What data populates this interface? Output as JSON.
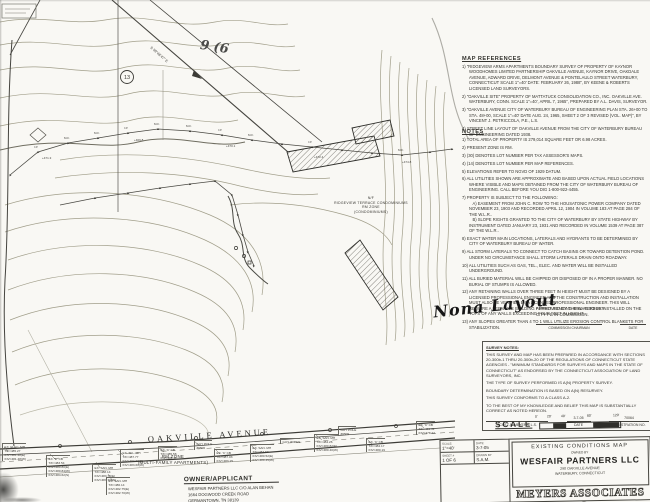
{
  "colors": {
    "paper": "#f9f8f4",
    "ink": "#2e2d29",
    "pencil": "#4a4a48",
    "contour": "#93907f"
  },
  "map": {
    "street": "OAKVILLE AVENUE",
    "bearing": "S 59°48'47\" E",
    "circled_lot": "13",
    "pencil_note": "9 (6",
    "zone_mf": [
      "RM ZONE",
      "(MULTI-FAMILY APARTMENTS)"
    ],
    "zone_condo": [
      "N/F",
      "RIDGEVIEW TERRACE CONDOMINIUMS",
      "RM ZONE",
      "(CONDOMINIUMS)"
    ],
    "pins": [
      "I.P.",
      "M.F.",
      "M.F.",
      "I.P.",
      "M.F.",
      "M.F.",
      "I.P.",
      "M.F.",
      "I.P.",
      "M.F."
    ],
    "elevs": [
      "+471.3",
      "+469.8",
      "+470.1",
      "+472.4",
      "+474.8"
    ],
    "callouts": [
      {
        "lines": [
          "EX. ELEC. MH",
          "T/F=485.27",
          "INV=481.48(E)",
          "INV=481.48(W)"
        ]
      },
      {
        "lines": [
          "EX. 'C' CB",
          "T/F=483.54",
          "INV=480.80(E)",
          "INV=480.84(W)",
          "INV=484.62(S)"
        ]
      },
      {
        "lines": [
          "EX. SAN. MH",
          "T/F=488.14",
          "INV=483.75(E)",
          "INV=483.70(W)"
        ]
      },
      {
        "lines": [
          "EX. TEL. MH",
          "T/F=487.77",
          "INV=483.60(E)",
          "INV=483.60(W)"
        ]
      },
      {
        "lines": [
          "EX. 'C' CB",
          "T/F=485.58",
          "INV=481.11"
        ]
      },
      {
        "lines": [
          "GUY POLE",
          "#6506"
        ]
      },
      {
        "lines": [
          "EX. 'C' CB",
          "T/F=487.03",
          "INV=483.15"
        ]
      },
      {
        "lines": [
          "EX. SAN. MH",
          "T/F=483.62",
          "INV=480.52(E)",
          "INV=480.45(W)"
        ]
      },
      {
        "lines": [
          "GUY WIRES"
        ]
      },
      {
        "lines": [
          "EX. SAN. MH",
          "T/F=484.26",
          "INV=480.82(E)",
          "INV=480.40(W)"
        ]
      },
      {
        "lines": [
          "GUY POLE",
          "#6509"
        ]
      },
      {
        "lines": [
          "EX. 'C' CB",
          "T/F=484.17",
          "INV=480.19"
        ]
      },
      {
        "lines": [
          "EX. 'C' CB",
          "T/F=481.41",
          "INV=478.22"
        ]
      },
      {
        "lines": [
          "EX. SAN. MH",
          "T/F=486.14",
          "INV=482.75(E)",
          "INV=482.70(W)"
        ]
      }
    ]
  },
  "owner_block": {
    "title": "OWNER/APPLICANT",
    "lines": [
      "WESFAIR PARTNERS LLC C/O ALAN BEHAN",
      "1664 DOGWOOD CREEK ROAD",
      "GERMANTOWN, TN 38139",
      "PH. (203) 755-3352"
    ]
  },
  "map_references": {
    "title": "MAP REFERENCES",
    "items": [
      "1) \"RIDGEVIEW ARMS APARTMENTS BOUNDARY SURVEY OF PROPERTY OF KAYNOR WOODHOMES LIMITED PARTNERSHIP OAKVILLE AVENUE, KAYNOR DRIVE, OAKDALE AVENUE, ADWARD DRIVE, DELMONT AVENUE & PONTELAULO STREET WATERBURY, CONNECTICUT SCALE 1\"=40' DATE: FEBRUARY 26, 1988\", BY KEENE & ROBERTS LICENSED LAND SURVEYORS.",
      "2) \"OAKVILLE SITE\" PROPERTY OF MATTATUCK CONSOLIDATION CO., INC. OAKVILLE AVE. WATERBURY, CONN. SCALE 1\"=40', APRIL 7, 1965\", PREPARED BY A.L. DAVIS, SURVEYOR.",
      "3) \"OAKVILLE AVENUE CITY OF WATERBURY BUREAU OF ENGINEERING PLAN STA. 26+00 TO STA. 48+00, SCALE 1\"=40' DATE AUG. 24, 1965, SHEET 2 OF 3 REVISED (VOL. MAP)\", BY VINCENT J. PETRICCOLA, P.E., L.S.",
      "4) STREET LINE LAYOUT OF OAKVILLE AVENUE FROM THE CITY OF WATERBURY BUREAU OF ENGINEERING DATED 1938."
    ]
  },
  "notes": {
    "title": "NOTES",
    "items": [
      "1) TOTAL AREA OF PROPERTY IS 279,014 SQUARE FEET OR 6.98 ACRES.",
      "2) PRESENT ZONE IS RM.",
      "3) (30) DENOTES LOT NUMBER PER TAX ASSESSOR'S MAPS.",
      "4) (14) DENOTES LOT NUMBER PER MAP REFERENCES.",
      "5) ELEVATIONS REFER TO NGVD OF 1929 DATUM.",
      "6) ALL UTILITIES SHOWN ARE APPROXIMATE AND BASED UPON ACTUAL FIELD LOCATIONS WHERE VISIBLE AND MAPS OBTAINED FROM THE CITY OF WATERBURY BUREAU OF ENGINEERING. CALL BEFORE YOU DIG 1-800-922-4455.",
      "7) PROPERTY IS SUBJECT TO THE FOLLOWING:\n   A) EASEMENT FROM JOHN C. ROW TO THE HOUSATONIC POWER COMPANY DATED NOVEMBER 23, 1903 AND RECORDED APRIL 12, 1904 IN VOLUME 183 AT PAGE 284 OF THE W.L.R..\n   B) SLOPE RIGHTS GRANTED TO THE CITY OF WATERBURY BY STATE HIGHWAY BY INSTRUMENT DATED JANUARY 23, 1931 AND RECORDED IN VOLUME 1539 AT PAGE 387 OF THE W.L.R..",
      "8) EXACT WATER MAIN LOCATIONS, LATERALS AND HYDRANTS TO BE DETERMINED BY CITY OF WATERBURY BUREAU OF WATER.",
      "9) ALL STORM LATERALS TO CONNECT TO CATCH BASINS OR TOWARD DETENTION POND. UNDER NO CIRCUMSTANCE SHALL STORM LATERALS DRAIN ONTO ROADWAY.",
      "10) ALL UTILITIES SUCH AS GAS, TEL., ELEC. AND WATER WILL BE INSTALLED UNDERGROUND.",
      "11) ALL BURIED MATERIAL WILL BE CHIPPED OR DISPOSED OF IN A PROPER MANNER. NO BURIAL OF STUMPS IS ALLOWED.",
      "12) ANY RETAINING WALLS OVER THREE FEET IN HEIGHT MUST BE DESIGNED BY A LICENSED PROFESSIONAL ENGINEER AND THE CONSTRUCTION AND INSTALLATION MUST ALSO BE VERIFIED BY A LICENSED PROFESSIONAL ENGINEER. THIS WILL REQUIRE A SEPARATE BUILDING PERMIT. FENCING WILL ALSO BE INSTALLED ON THE TOPS OF ANY WALLS EXCEEDING FOUR FEET IN HEIGHT.",
      "13) ANY SLOPES GREATER THAN 4 TO 1 WILL UTILIZE EROSION CONTROL BLANKETS FOR STABILIZATION."
    ]
  },
  "handwriting": {
    "note": "Nona Layout"
  },
  "approval": {
    "line1": "APPROVED BY THE WATERBURY",
    "line2": "CITY PLAN COMMISSION.",
    "sig1": "COMMISSION CHAIRMAN",
    "sig2": "DATE"
  },
  "survey_notes": {
    "title": "SURVEY NOTES:",
    "paragraphs": [
      "THIS SURVEY AND MAP HAS BEEN PREPARED IN ACCORDANCE WITH SECTIONS 20-300b-1 THRU 20-300b-20 OF THE REGULATIONS OF CONNECTICUT STATE AGENCIES - \"MINIMUM STANDARDS FOR SURVEYS AND MAPS IN THE STATE OF CONNECTICUT\" AS ENDORSED BY THE CONNECTICUT ASSOCIATION OF LAND SURVEYORS, INC.",
      "THE TYPE OF SURVEY PERFORMED IS A(N) PROPERTY SURVEY.",
      "BOUNDARY DETERMINATION IS BASED ON A(N) RESURVEY.",
      "THIS SURVEY CONFORMS TO A CLASS A-2.",
      "TO THE BEST OF MY KNOWLEDGE AND BELIEF THIS MAP IS SUBSTANTIALLY CORRECT AS NOTED HEREON."
    ],
    "surveyor": "SCOTT A. MEYERS, L.S.",
    "date_value": "3-7-05",
    "date_label": "DATE",
    "reg_value": "70064",
    "reg_label": "REGISTRATION NO."
  },
  "scale_bar": {
    "label": "SCALE",
    "ticks": [
      "0'",
      "20'",
      "40'",
      "80'",
      "120'"
    ]
  },
  "title_block": {
    "scale_label": "SCALE:",
    "scale_value": "1\"=40'",
    "date_label": "DATE:",
    "date_value": "3-7-05",
    "sheet_label": "SHEET #",
    "sheet_value": "1 OF 6",
    "drawn_label": "DRAWN BY",
    "drawn_value": "S.A.M.",
    "map_title": "EXISTING CONDITIONS MAP",
    "owned_by": "OWNED BY",
    "owner": "WESFAIR PARTNERS LLC",
    "address1": "290 OAKVILLE AVENUE",
    "address2": "WATERBURY, CONNECTICUT",
    "firm": "MEYERS ASSOCIATES P.C."
  }
}
